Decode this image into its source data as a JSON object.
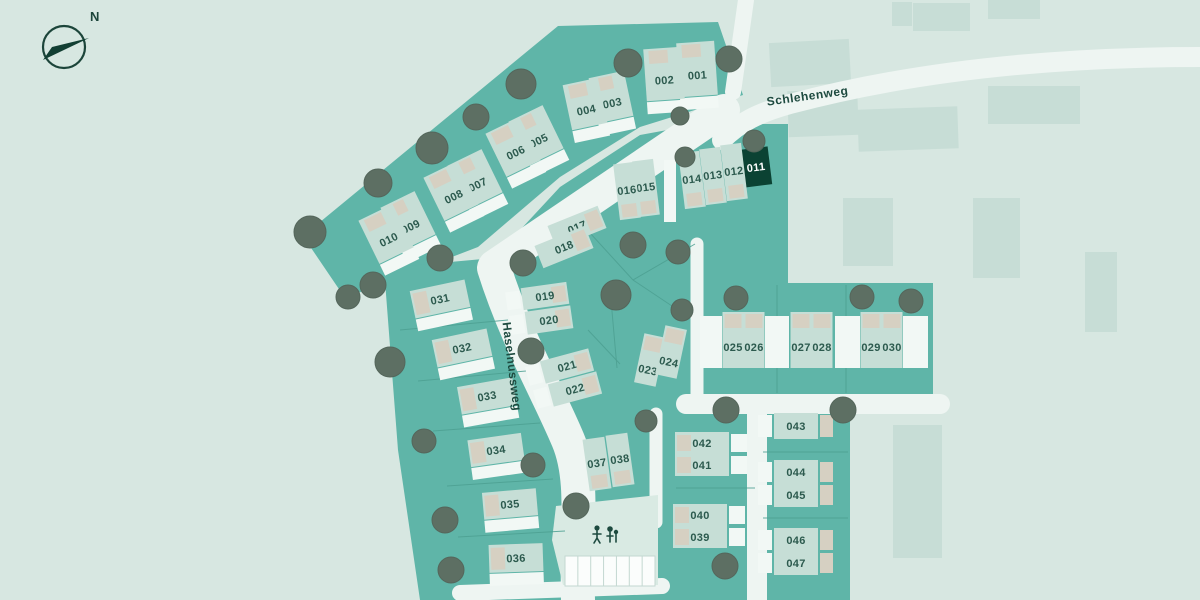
{
  "compass": {
    "label": "N"
  },
  "streets": {
    "schlehenweg": "Schlehenweg",
    "haselnussweg": "Haselnussweg"
  },
  "map": {
    "highlighted_plot": "011",
    "plots": [
      {
        "label": "001"
      },
      {
        "label": "002"
      },
      {
        "label": "003"
      },
      {
        "label": "004"
      },
      {
        "label": "005"
      },
      {
        "label": "006"
      },
      {
        "label": "007"
      },
      {
        "label": "008"
      },
      {
        "label": "009"
      },
      {
        "label": "010"
      },
      {
        "label": "011"
      },
      {
        "label": "012"
      },
      {
        "label": "013"
      },
      {
        "label": "014"
      },
      {
        "label": "015"
      },
      {
        "label": "016"
      },
      {
        "label": "017"
      },
      {
        "label": "018"
      },
      {
        "label": "019"
      },
      {
        "label": "020"
      },
      {
        "label": "021"
      },
      {
        "label": "022"
      },
      {
        "label": "023"
      },
      {
        "label": "024"
      },
      {
        "label": "025"
      },
      {
        "label": "026"
      },
      {
        "label": "027"
      },
      {
        "label": "028"
      },
      {
        "label": "029"
      },
      {
        "label": "030"
      },
      {
        "label": "031"
      },
      {
        "label": "032"
      },
      {
        "label": "033"
      },
      {
        "label": "034"
      },
      {
        "label": "035"
      },
      {
        "label": "036"
      },
      {
        "label": "037"
      },
      {
        "label": "038"
      },
      {
        "label": "039"
      },
      {
        "label": "040"
      },
      {
        "label": "041"
      },
      {
        "label": "042"
      },
      {
        "label": "043"
      },
      {
        "label": "044"
      },
      {
        "label": "045"
      },
      {
        "label": "046"
      },
      {
        "label": "047"
      }
    ]
  },
  "amenities": {
    "playground": "playground",
    "parking_spaces": 7
  },
  "colors": {
    "background": "#d7e7e1",
    "parcel_teal": "#5fb5a8",
    "building_light": "#c6ded6",
    "roof_beige": "#d6d0c2",
    "terrace_white": "#f2f8f5",
    "road": "#eef5f2",
    "playground_area": "#d9eae3",
    "existing_building": "#c7ddd6",
    "tree": "#5d6f63",
    "boundary": "#4da092",
    "highlight_green": "#0b4233",
    "label_text": "#2c5a4e",
    "street_text": "#1d4a3f",
    "highlight_label_text": "#ffffff"
  }
}
